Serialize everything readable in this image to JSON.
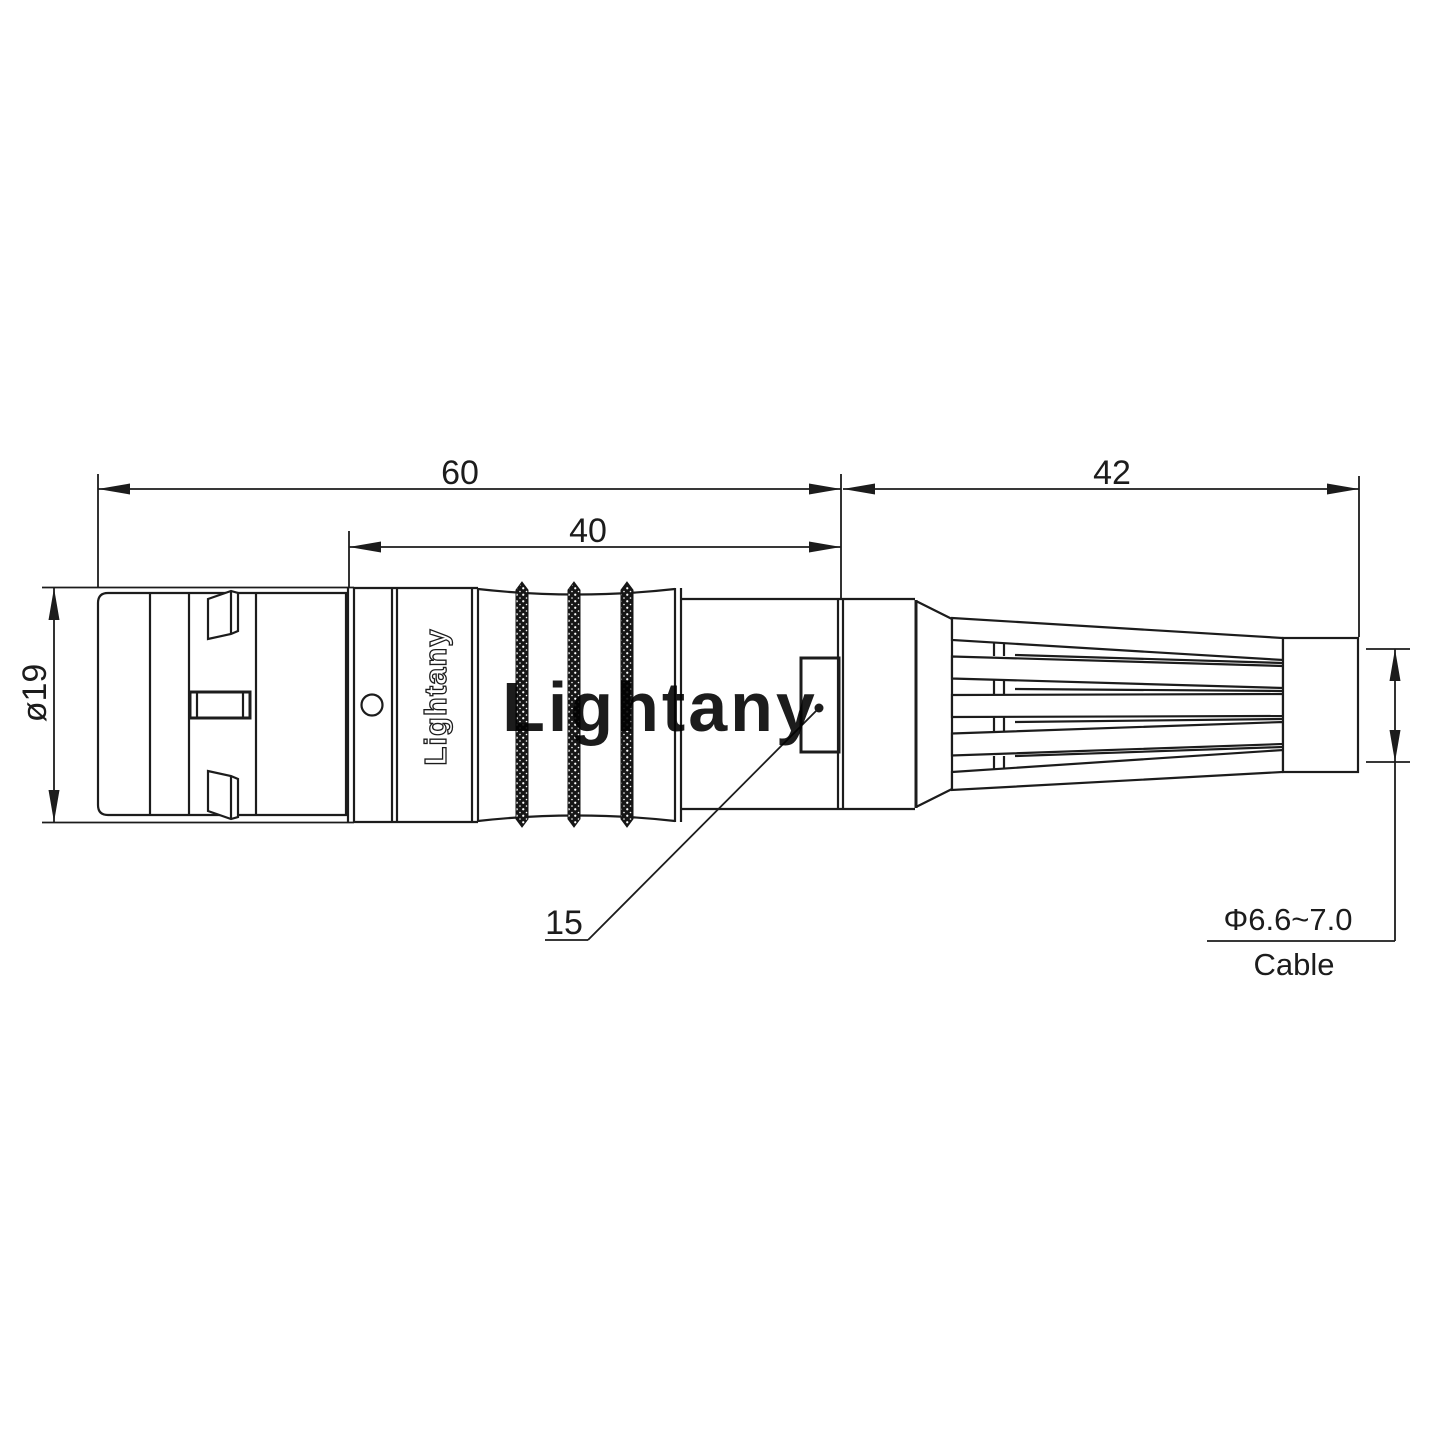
{
  "drawing": {
    "title": "connector-dimensional-drawing",
    "background_color": "#ffffff",
    "line_color": "#1c1c1c",
    "watermark": {
      "text": "Lightany",
      "color": "#f0a6a6"
    },
    "brand_label": "Lightany",
    "dimensions": {
      "overall_length": "60",
      "mid_length": "40",
      "boot_length": "42",
      "body_diameter": "ø19",
      "feature_ref": "15",
      "cable_diameter": "Φ6.6~7.0",
      "cable_label": "Cable"
    }
  }
}
